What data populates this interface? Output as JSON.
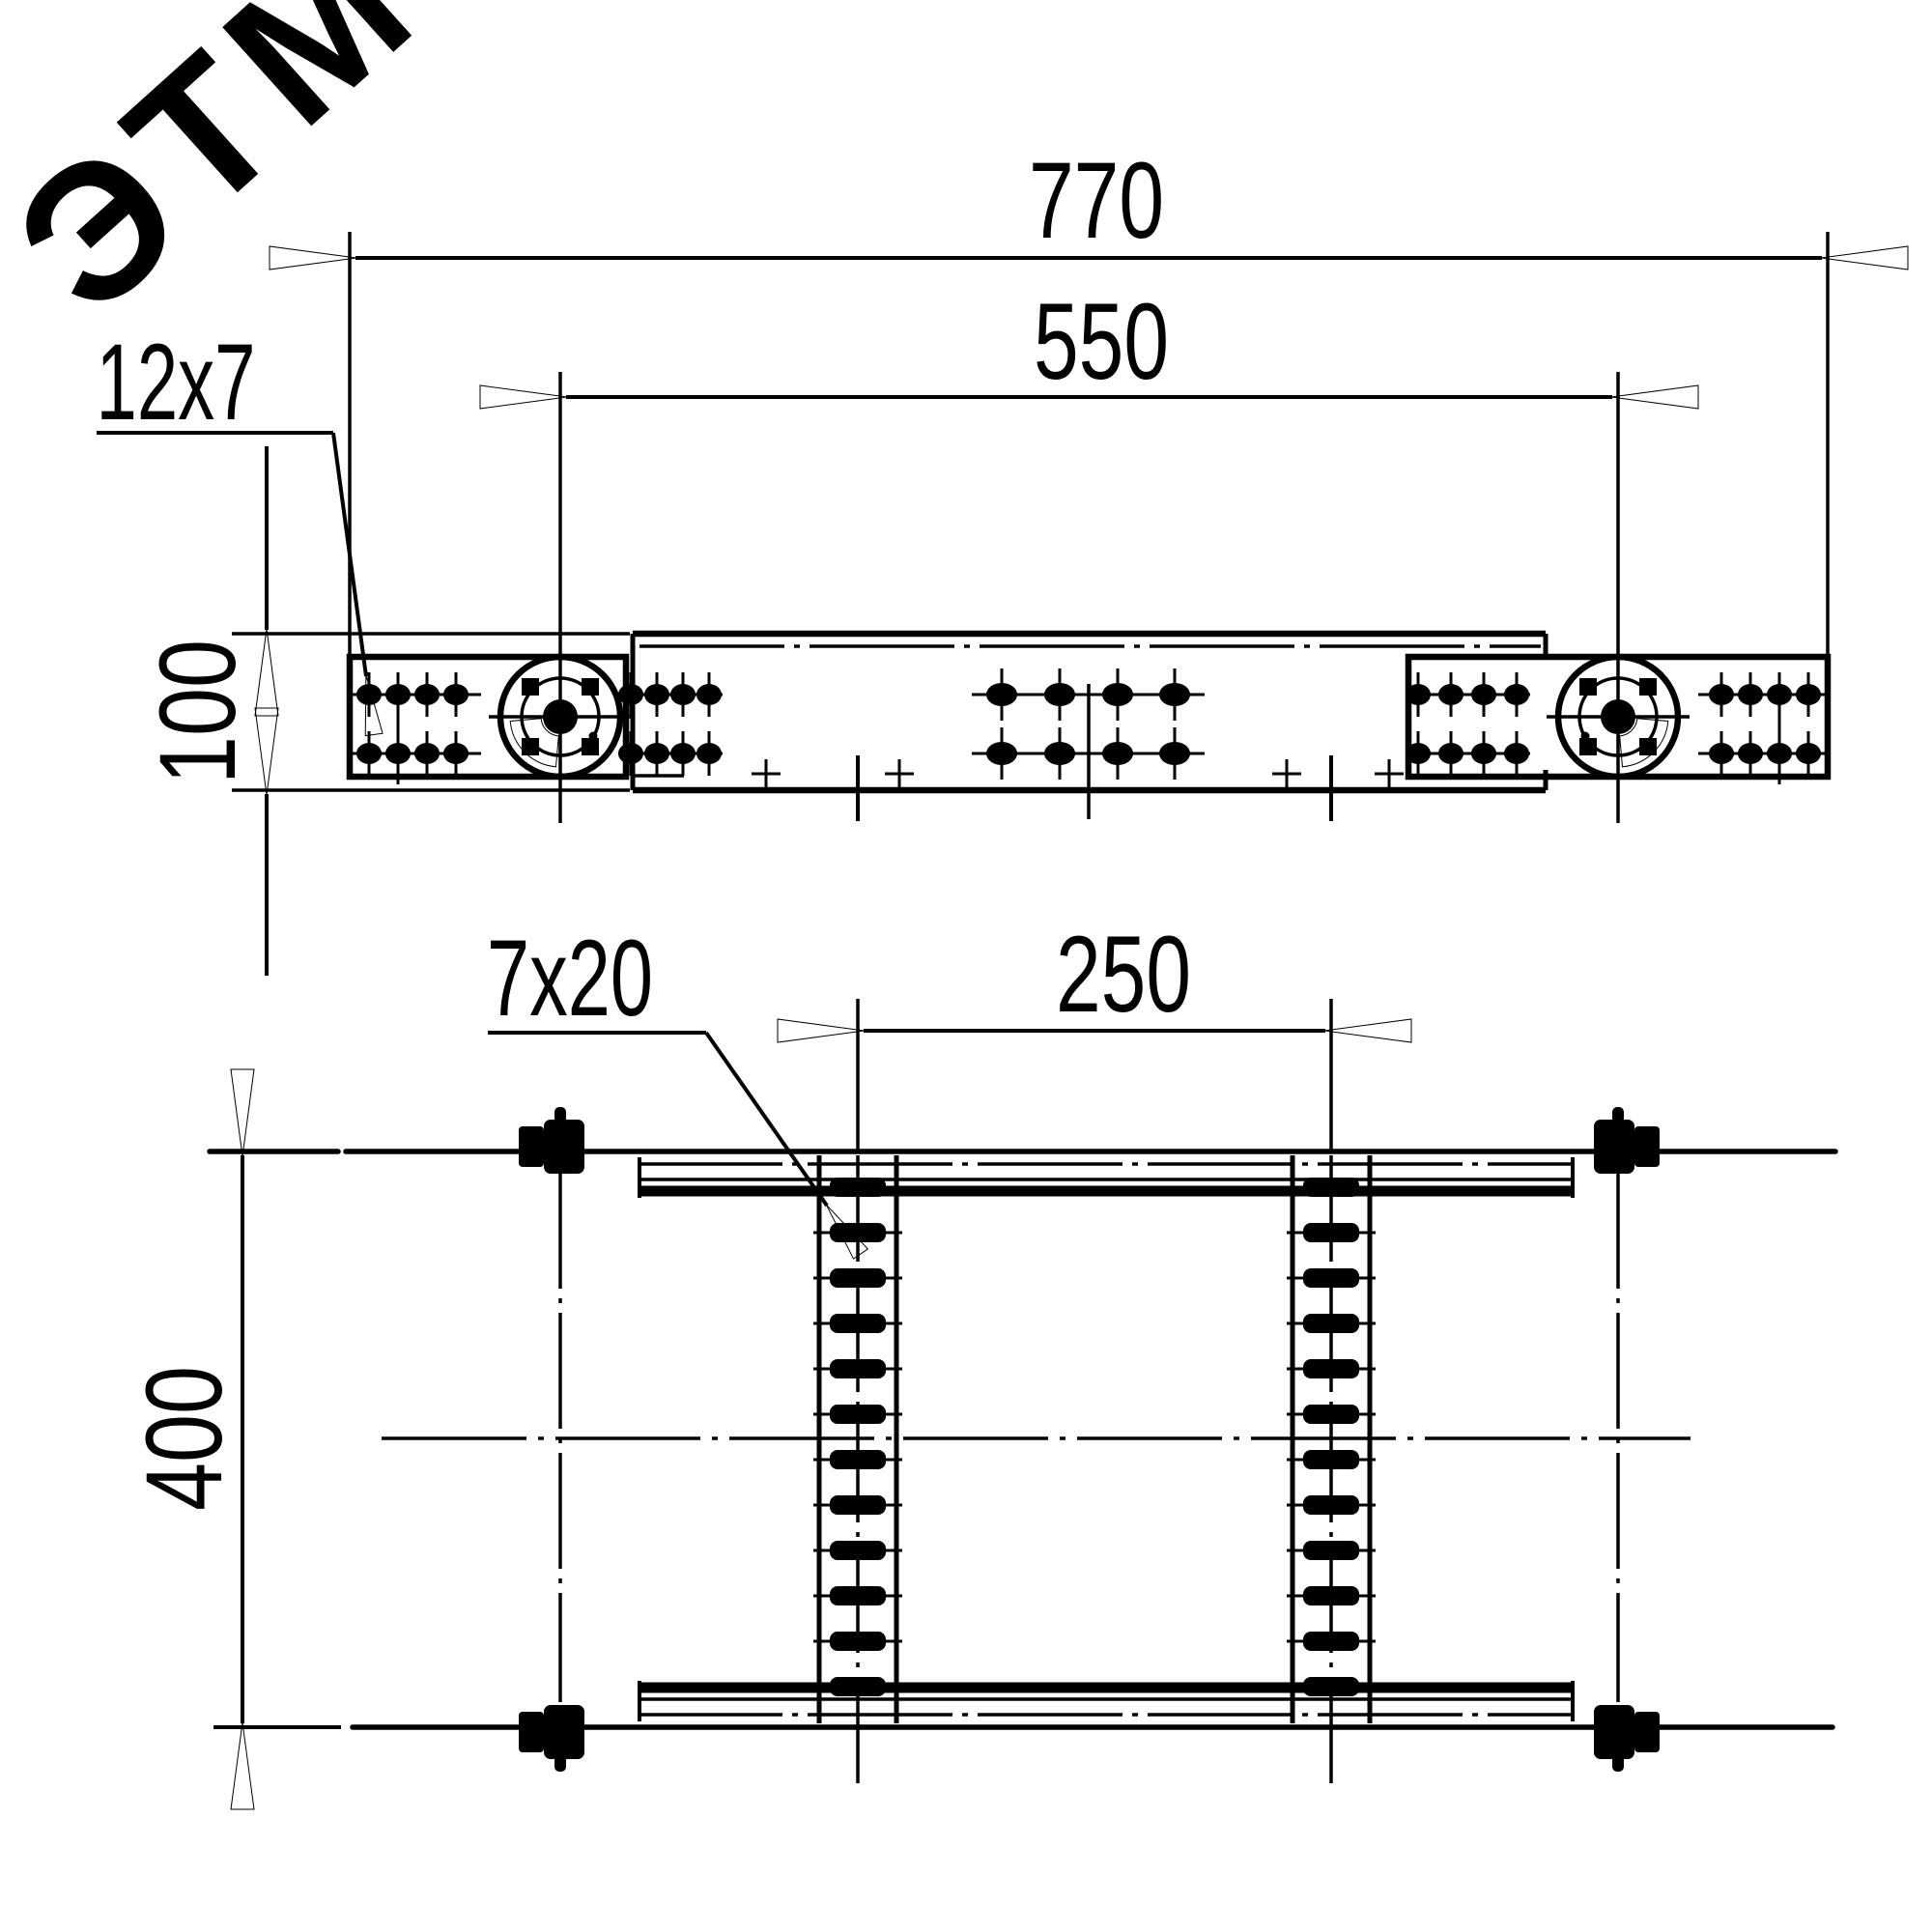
{
  "meta": {
    "type": "technical-drawing",
    "background_color": "#ffffff",
    "line_color": "#000000",
    "watermark_color": "#f0f0f0"
  },
  "watermark": {
    "text": "ЭТМ"
  },
  "top_view": {
    "dim_overall_width": "770",
    "dim_hinge_spacing": "550",
    "dim_height": "100",
    "label_slot": "12x7"
  },
  "bottom_view": {
    "dim_rung_spacing": "250",
    "dim_rail_spacing": "400",
    "label_slot": "7x20"
  }
}
